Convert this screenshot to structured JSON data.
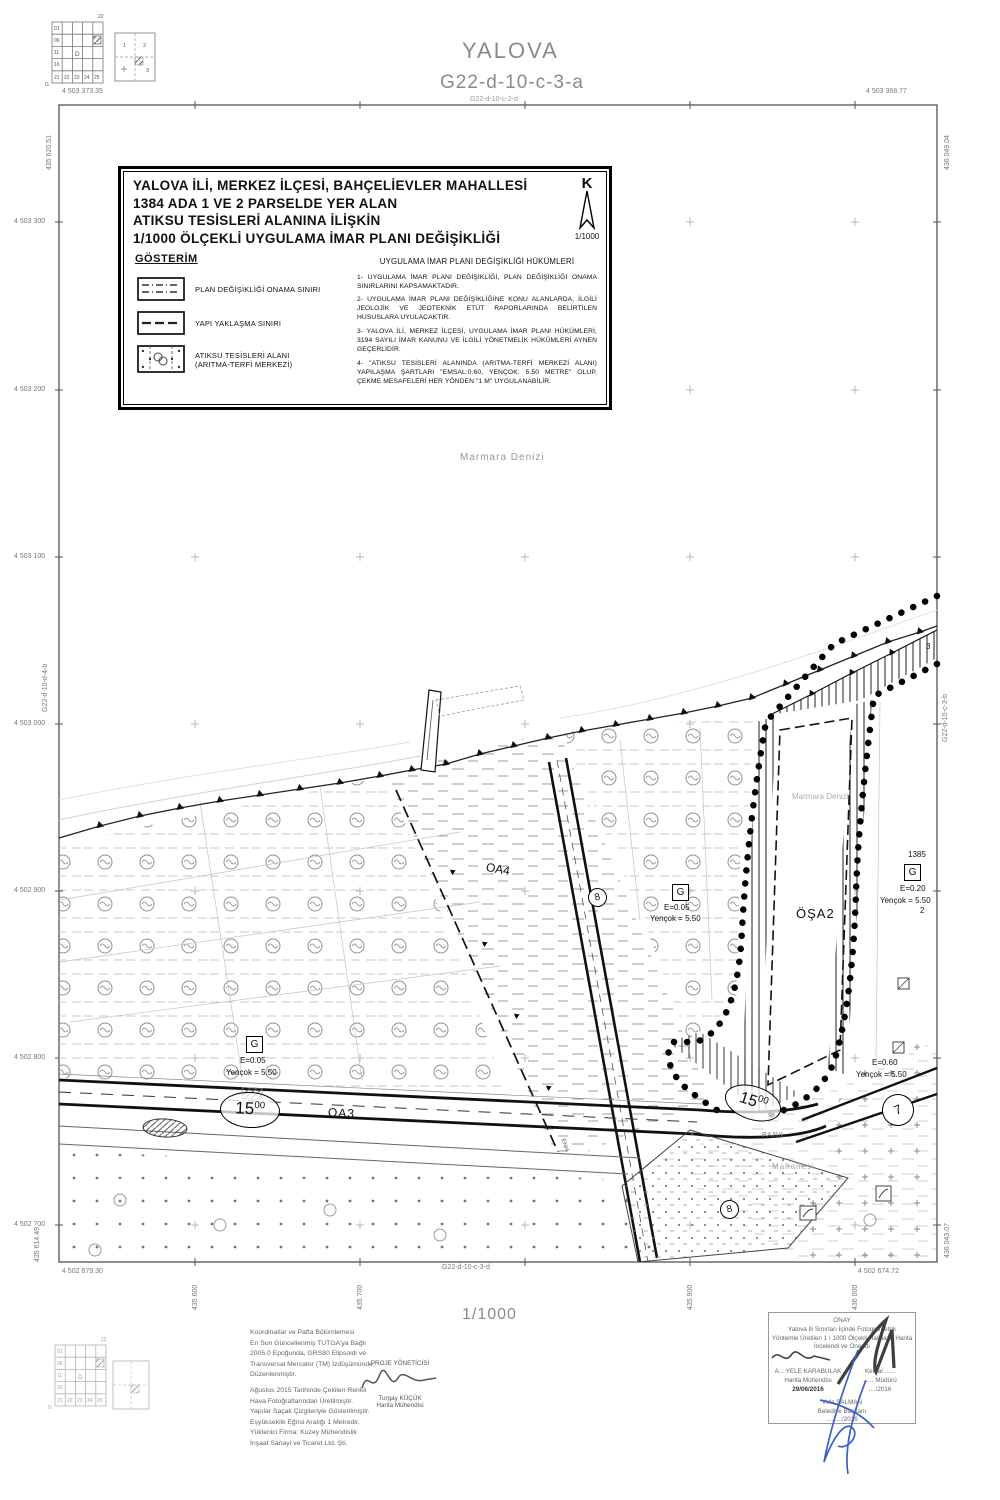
{
  "header": {
    "city": "YALOVA",
    "sheet": "G22-d-10-c-3-a",
    "sheet_top_small": "G22-d-10-c-2-d"
  },
  "index": {
    "corner": "22",
    "letter": "G",
    "col1": [
      "01",
      "06",
      "11",
      "16",
      "21"
    ],
    "bottom": [
      "22",
      "23",
      "24",
      "25"
    ],
    "center": "D",
    "q1": "1",
    "q2": "2",
    "q3": "3"
  },
  "frame": {
    "corner_tl_n": "4 503 373.35",
    "corner_tl_e": "435 620.51",
    "corner_tr_n": "4 503 368.77",
    "corner_tr_e": "436 049.04",
    "corner_bl_n": "4 502 679.30",
    "corner_bl_e": "435 614.49",
    "corner_br_n": "4 502 674.72",
    "corner_br_e": "436 043.07",
    "left_ticks": [
      "4 503 300",
      "4 503 200",
      "4 503 100",
      "4 503 000",
      "4 502 900",
      "4 502 800",
      "4 502 700"
    ],
    "bottom_ticks": [
      "435 600",
      "435 700",
      "435 900",
      "436 000"
    ],
    "sheet_bottom": "G22-d-10-c-3-d",
    "sheet_left": "G22-d-10-d-4-b",
    "sheet_right": "G22-d-10-c-3-b"
  },
  "title_block": {
    "line1": "YALOVA İLİ, MERKEZ İLÇESİ, BAHÇELİEVLER MAHALLESİ",
    "line2": "1384 ADA 1 VE 2 PARSELDE YER ALAN",
    "line3": "ATIKSU TESİSLERİ ALANINA İLİŞKİN",
    "line4": "1/1000 ÖLÇEKLİ UYGULAMA İMAR PLANI DEĞİŞİKLİĞİ",
    "north_letter": "K",
    "north_scale": "1/1000",
    "legend_title": "GÖSTERİM",
    "legend1": "PLAN DEĞİŞİKLİĞİ ONAMA SINIRI",
    "legend2": "YAPI YAKLAŞMA SINIRI",
    "legend3a": "ATIKSU TESİSLERİ ALANI",
    "legend3b": "(ARITMA-TERFİ MERKEZİ)",
    "provisions_title": "UYGULAMA İMAR PLANI DEĞİŞİKLİĞİ HÜKÜMLERİ",
    "provisions": [
      "1- UYGULAMA İMAR PLANI DEĞİŞİKLİĞİ, PLAN DEĞİŞİKLİĞİ ONAMA SINIRLARINI KAPSAMAKTADIR.",
      "2- UYGULAMA İMAR PLANI DEĞİŞİKLİĞİNE KONU ALANLARDA, İLGİLİ JEOLOJİK VE JEOTEKNİK ETÜT RAPORLARINDA BELİRTİLEN HUSUSLARA UYULACAKTIR.",
      "3- YALOVA İLİ, MERKEZ İLÇESİ, UYGULAMA İMAR PLANI HÜKÜMLERİ, 3194 SAYILI İMAR KANUNU VE İLGİLİ YÖNETMELİK HÜKÜMLERİ AYNEN GEÇERLİDİR.",
      "4- \"ATIKSU TESİSLERİ ALANINDA (ARITMA-TERFİ MERKEZİ ALANI) YAPILAŞMA ŞARTLARI \"EMSAL:0.60, YENÇOK: 5.50 METRE\" OLUP, ÇEKME MESAFELERİ HER YÖNDEN \"1 M\" UYGULANABİLİR."
    ]
  },
  "map": {
    "sea_label": "Marmara Denizi",
    "oa4": "OA4",
    "oa3": "OA3",
    "osa2": "ÖŞA2",
    "g": "G",
    "e005": "E=0.05",
    "e020": "E=0.20",
    "e060": "E=0.60",
    "yencok": "Yençok = 5.50",
    "w15": "15",
    "w15sup": "00",
    "n8": "8",
    "n7": "7",
    "n3": "3",
    "n2": "2",
    "block1385": "1385",
    "park": "PARK.",
    "mahalle": "Mahallesi",
    "enh": "ENH"
  },
  "footer": {
    "scale": "1/1000",
    "notes1": [
      "Koordinatlar ve Pafta Bölümlemesi",
      "En Son Güncellenmiş TUTGA'ya Bağlı",
      "2005.0 Epoğunda, GRS80 Elipsoidi ve",
      "Transversal Mercator (TM) İzdüşümünde,",
      "Düzenlenmiştir."
    ],
    "notes2": [
      "Ağustos 2015 Tarihinde Çekilen Renkli",
      "Hava Fotoğraflarından Üretilmiştir.",
      "Yapılar Saçak Çizgileriyle Gösterilmiştir.",
      "Eşyükseklik Eğrisi Aralığı 1 Metredir.",
      "Yüklenici Firma: Kuzey Mühendislik",
      "İnşaat Sanayi ve Ticaret Ltd. Şti."
    ],
    "pm_title": "PROJE YÖNETİCİSİ",
    "pm_name": "Turgay KÜÇÜK",
    "pm_role": "Harita Mühendisi",
    "onay": {
      "title": "ONAY",
      "line1": "Yalova İli Sınırları İçinde  Fotogrametrik",
      "line2": "Yöntemle Üretilen 1 / 1000  Ölçekli Halihazır Harita",
      "line3": "İncelendi ve Onandı",
      "sig1_name": "A... YELE KARABULAK",
      "sig1_role": "Harita Mühendisi",
      "sig1_date": "29/06/2016",
      "sig2_name": "Kemal ......",
      "sig2_role": "...... Müdürü",
      "sig2_date": "..../2016",
      "sig3_name": "Vefa SALMAN",
      "sig3_role": "Belediye Başkanı",
      "sig3_date": "..../..../2016"
    }
  }
}
